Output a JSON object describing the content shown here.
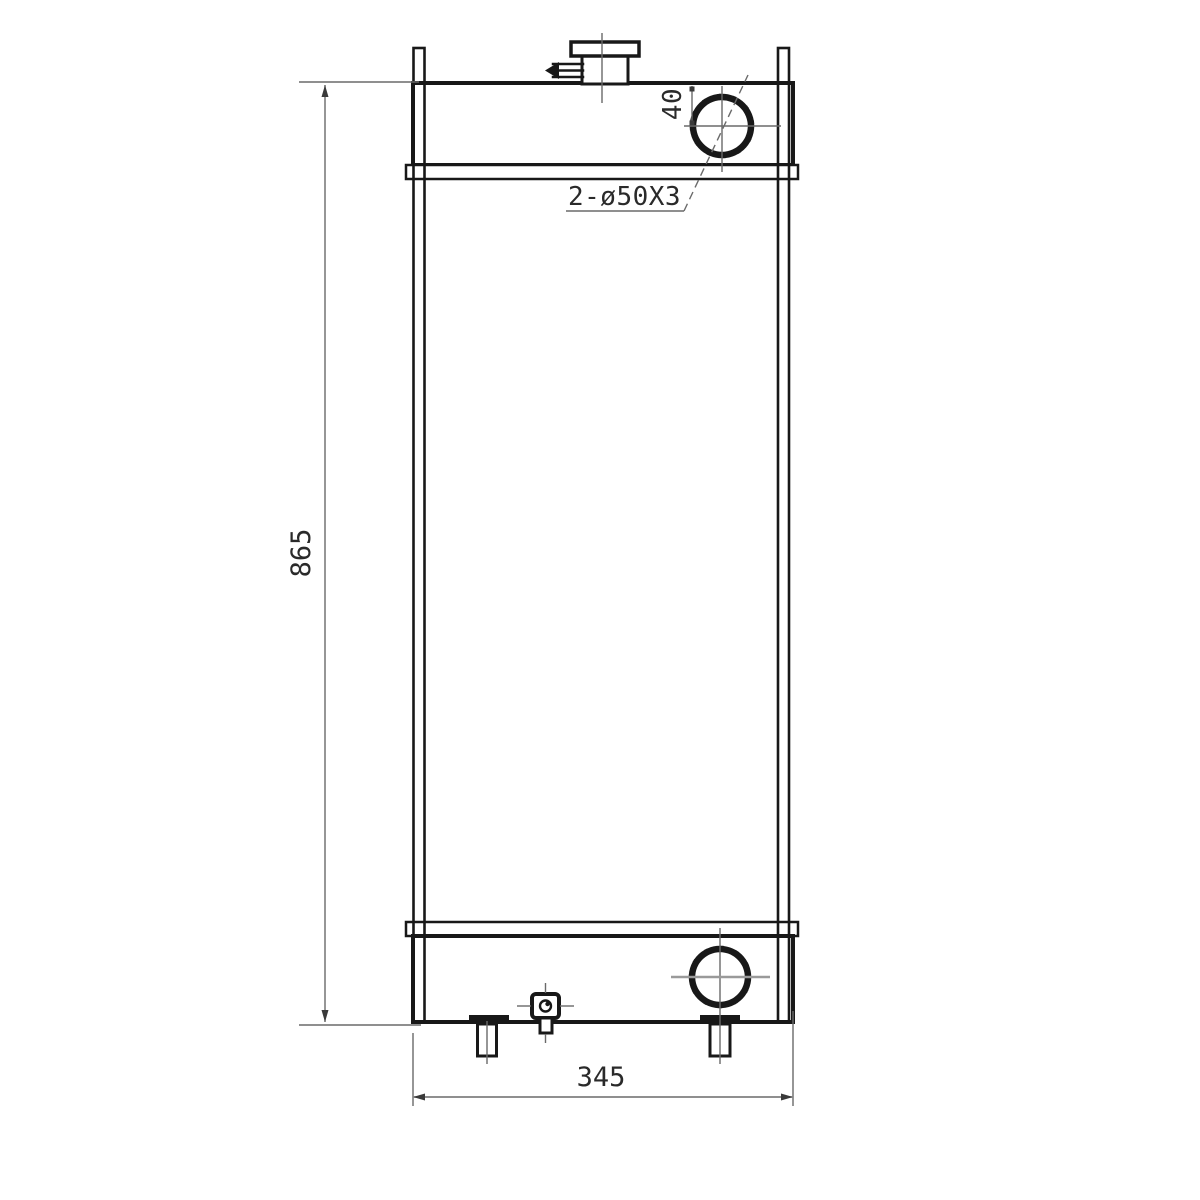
{
  "drawing": {
    "type": "engineering-diagram",
    "subject": "radiator-front-view",
    "labels": {
      "height": "865",
      "width": "345",
      "pipe_offset": "40",
      "pipe_spec": "2-ø50X3"
    },
    "colors": {
      "ink": "#181818",
      "thin": "#6a6a6a",
      "bg": "#ffffff"
    }
  }
}
